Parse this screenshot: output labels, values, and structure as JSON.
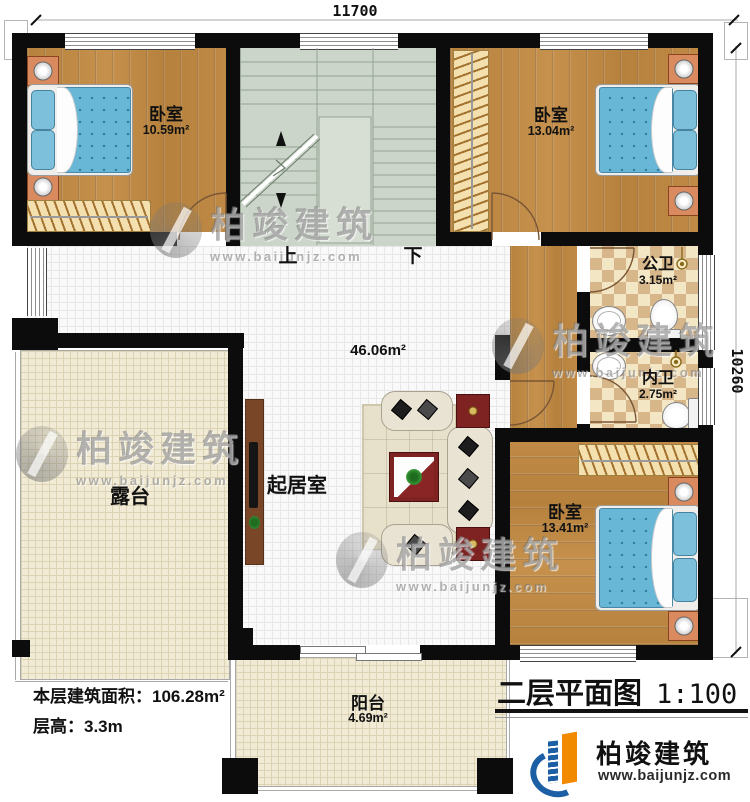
{
  "dimensions": {
    "width_mm": "11700",
    "height_mm": "10260"
  },
  "rooms": {
    "bedroom1": {
      "label": "卧室",
      "area": "10.59m²"
    },
    "bedroom2": {
      "label": "卧室",
      "area": "13.04m²"
    },
    "public_bath": {
      "label": "公卫",
      "area": "3.15m²"
    },
    "private_bath": {
      "label": "内卫",
      "area": "2.75m²"
    },
    "bedroom3": {
      "label": "卧室",
      "area": "13.41m²"
    },
    "living": {
      "label": "起居室",
      "area": "46.06m²"
    },
    "terrace": {
      "label": "露台"
    },
    "balcony": {
      "label": "阳台",
      "area": "4.69m²"
    }
  },
  "stairs": {
    "up": "上",
    "down": "下"
  },
  "info": {
    "area_label": "本层建筑面积：",
    "area_value": "106.28m²",
    "height_label": "层高：",
    "height_value": "3.3m"
  },
  "title": {
    "plan": "二层平面图",
    "scale": "1:100"
  },
  "brand": {
    "name": "柏竣建筑",
    "website": "www.baijunjz.com"
  },
  "colors": {
    "wall": "#0c0c0c",
    "wood": "#b8843f",
    "stair": "#ccd5ca",
    "tile_cream": "#f1ebd6",
    "checker_tan": "#d7b68a",
    "bed_blue": "#68b7d6",
    "logo_blue": "#1d5fa5",
    "logo_orange": "#f28a00"
  }
}
